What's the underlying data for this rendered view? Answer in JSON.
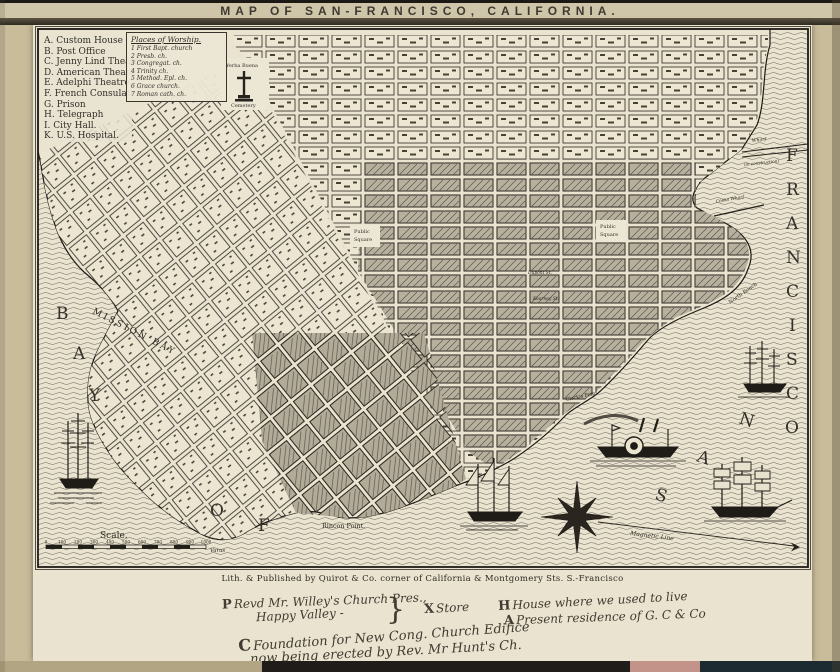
{
  "title": "MAP OF SAN-FRANCISCO, CALIFORNIA.",
  "legend": {
    "items": [
      "A. Custom House",
      "B. Post Office",
      "C. Jenny Lind Theatre",
      "D. American Theatre",
      "E. Adelphi Theatre",
      "F. French Consulate",
      "G. Prison",
      "H. Telegraph",
      "I. City Hall.",
      "K. U.S. Hospital."
    ]
  },
  "worship": {
    "title": "Places of Worship.",
    "items": [
      "1  First Bapt. church",
      "2  Presb. ch.",
      "3  Congregat. ch.",
      "4  Trinity ch.",
      "5  Method. Epl. ch.",
      "6  Grace church.",
      "7  Roman cath. ch."
    ]
  },
  "map": {
    "bay_letters": [
      "B",
      "A",
      "Y"
    ],
    "of_letters": [
      "O",
      "F"
    ],
    "san_letters": [
      "S",
      "A",
      "N"
    ],
    "francisco_letters": [
      "F",
      "R",
      "A",
      "N",
      "C",
      "I",
      "S",
      "C",
      "O"
    ],
    "mission_bay": "MISSION BAY",
    "labels": {
      "yerba_buena": "Yerba Buena",
      "cemetery": "Cemetery",
      "public_1a": "Public",
      "public_1b": "Square",
      "public_2a": "Public",
      "public_2b": "Square",
      "north_beach": "North Beach",
      "clarks_point": "Clark's Point",
      "rincon_point": "Rincon Point.",
      "wharf": "Wharf",
      "in_construction": "(in construction)",
      "cooks_wharf": "Cooks Wharf",
      "magnetic_line": "Magnetic Line",
      "dupont_st": "Dupont St.",
      "kearney_st": "Kearney St."
    },
    "scale": {
      "title": "Scale.",
      "ticks": [
        "0",
        "100",
        "200",
        "300",
        "400",
        "500",
        "600",
        "700",
        "800",
        "900",
        "1000"
      ],
      "unit": "Varas"
    }
  },
  "imprint": "Lith. & Published by Quirot & Co. corner of California & Montgomery Sts. S.-Francisco",
  "annotations": {
    "line1_sym": "P",
    "line1": "Revd Mr. Willey's Church Pres.,",
    "line2": "Happy Valley - ",
    "brace": "}",
    "store_sym": "X",
    "store": "Store",
    "house_sym": "H",
    "house": "House where we used to live",
    "residence_sym": "A",
    "residence": "Present residence of G. C & Co",
    "foundation_sym": "C",
    "foundation": "Foundation for New Cong. Church Edifice",
    "erected": "now being erected by Rev. Mr Hunt's Ch."
  },
  "colors": {
    "paper": "#c8bc9b",
    "sheet": "#e9e3cf",
    "ink": "#211e19",
    "water_line": "#6b675c",
    "dense_block": "#b7b09d",
    "strip_pink": "#c3938a",
    "strip_teal": "#1b2b31"
  }
}
